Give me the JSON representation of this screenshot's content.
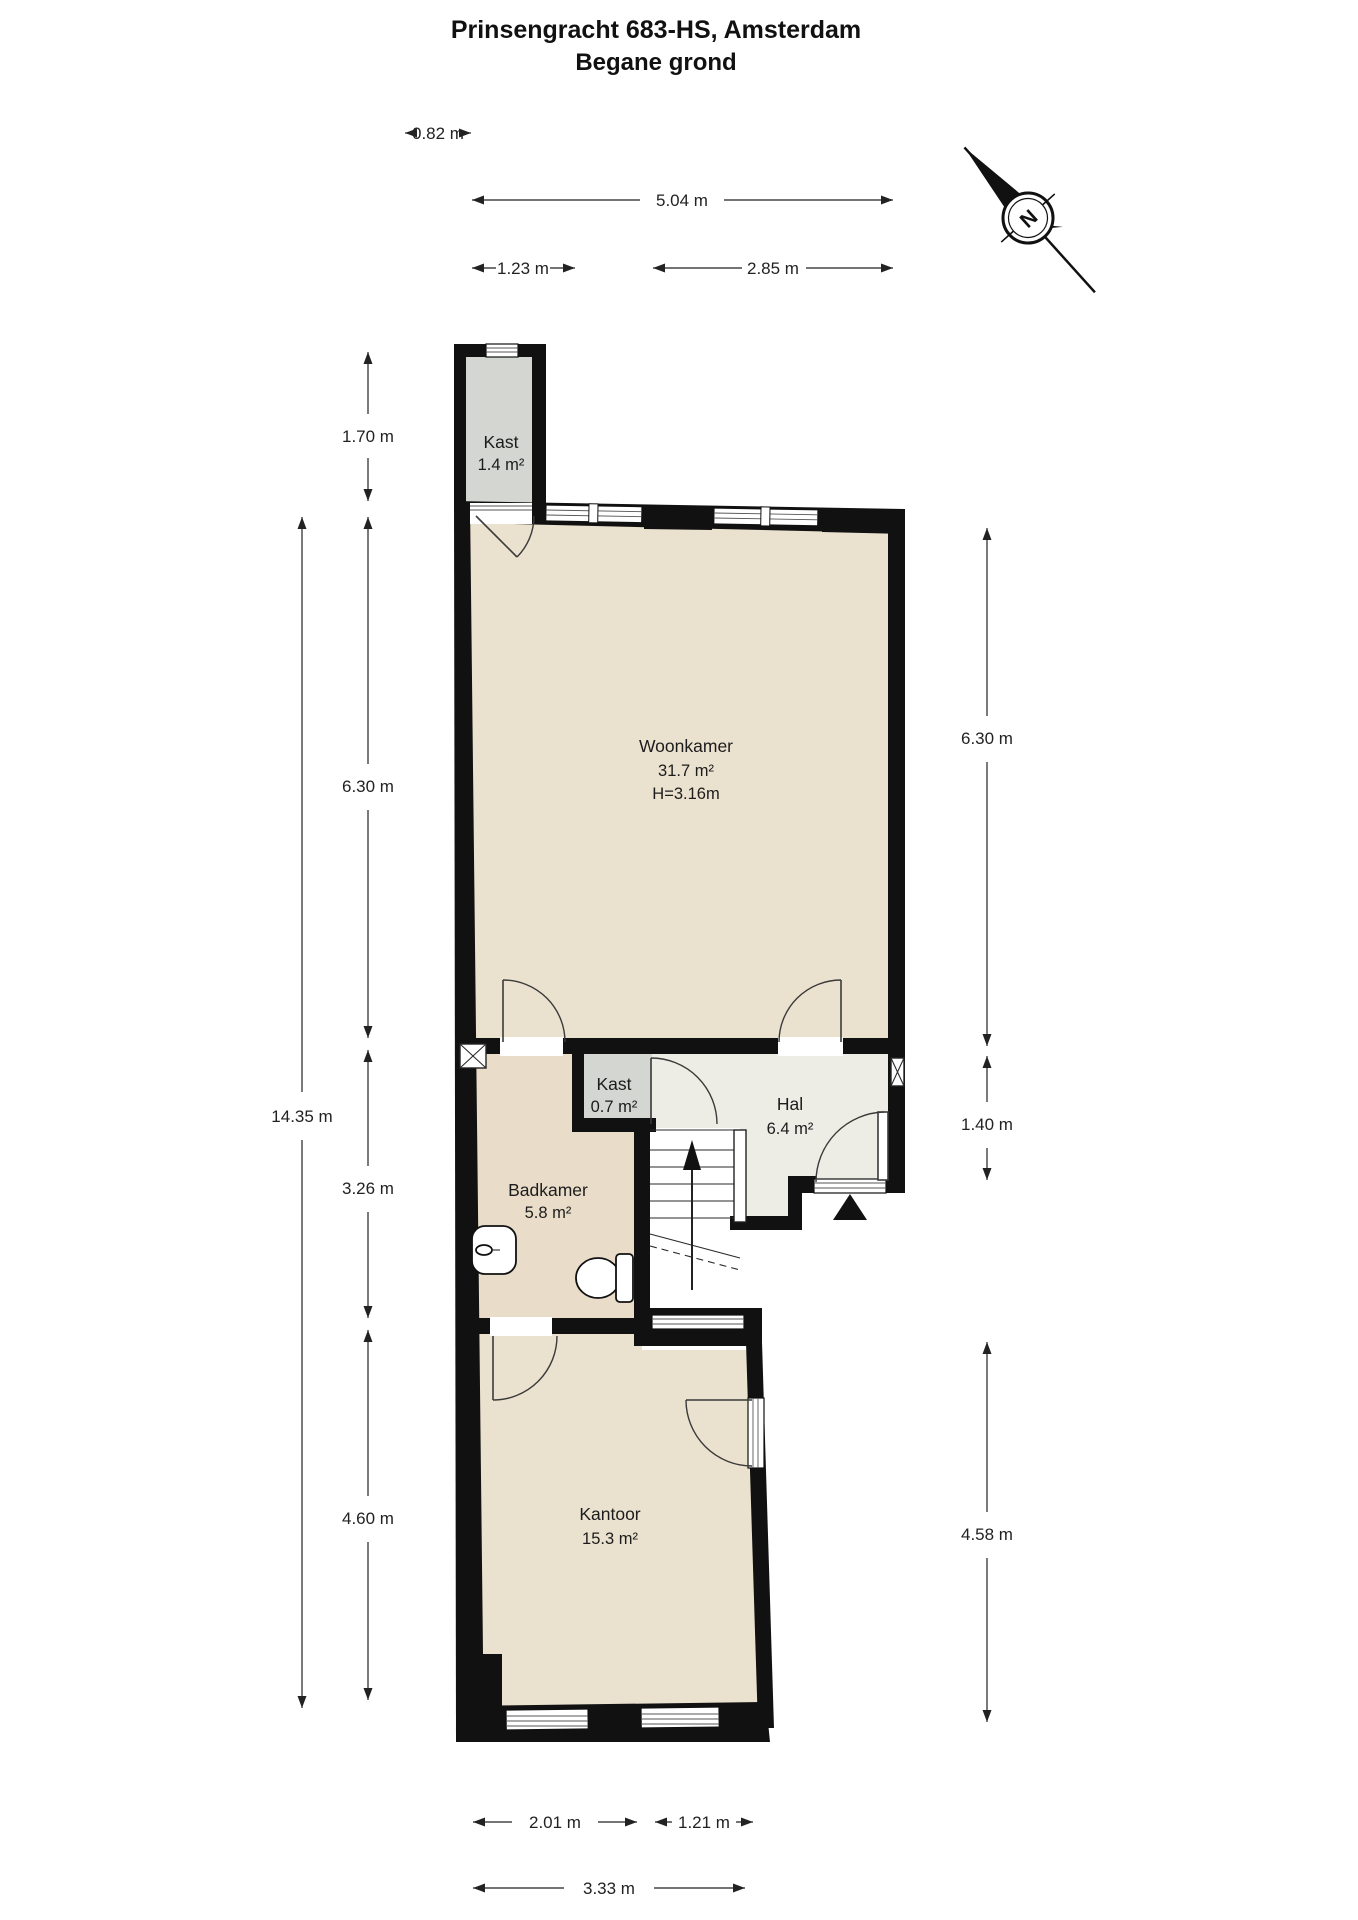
{
  "title": {
    "line1": "Prinsengracht 683-HS, Amsterdam",
    "line2": "Begane grond"
  },
  "compass": {
    "label": "N"
  },
  "rooms": {
    "kast_top": {
      "name": "Kast",
      "area": "1.4 m²"
    },
    "woonkamer": {
      "name": "Woonkamer",
      "area": "31.7 m²",
      "ceiling": "H=3.16m"
    },
    "kast_mid": {
      "name": "Kast",
      "area": "0.7 m²"
    },
    "hal": {
      "name": "Hal",
      "area": "6.4 m²"
    },
    "badkamer": {
      "name": "Badkamer",
      "area": "5.8 m²"
    },
    "kantoor": {
      "name": "Kantoor",
      "area": "15.3 m²"
    }
  },
  "dimensions": {
    "top_kast_width": "0.82 m",
    "top_total_width": "5.04 m",
    "top_left_width": "1.23 m",
    "top_right_width": "2.85 m",
    "left_kast_height": "1.70 m",
    "left_woonkamer": "6.30 m",
    "left_total": "14.35 m",
    "left_badkamer": "3.26 m",
    "left_kantoor": "4.60 m",
    "right_woonkamer": "6.30 m",
    "right_hal": "1.40 m",
    "right_kantoor": "4.58 m",
    "bottom_window_left": "2.01 m",
    "bottom_window_right": "1.21 m",
    "bottom_total": "3.33 m"
  },
  "colors": {
    "wall": "#111111",
    "floor_living": "#ebe1cf",
    "floor_bath": "#e9ddc9",
    "floor_hall": "#edece5",
    "floor_closet": "#d3d6d1",
    "dimension": "#222222"
  }
}
